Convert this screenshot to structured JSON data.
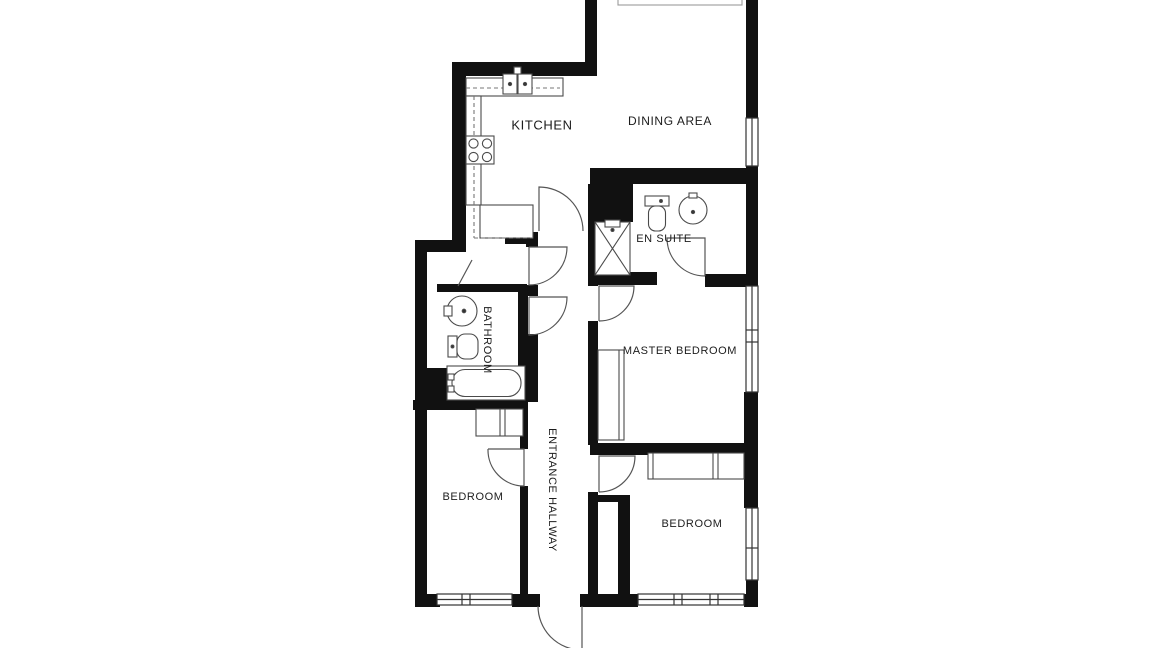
{
  "floor_plan": {
    "rooms": {
      "kitchen": {
        "label": "KITCHEN"
      },
      "dining": {
        "label": "DINING AREA"
      },
      "ensuite": {
        "label": "EN SUITE"
      },
      "master": {
        "label": "MASTER BEDROOM"
      },
      "bathroom": {
        "label": "BATHROOM"
      },
      "bedroom1": {
        "label": "BEDROOM"
      },
      "bedroom2": {
        "label": "BEDROOM"
      },
      "hallway": {
        "label": "ENTRANCE HALLWAY"
      }
    },
    "colors": {
      "wall": "#111111",
      "fixture_line": "#4a4a4a",
      "background": "#ffffff",
      "text": "#1c1c1c"
    }
  }
}
